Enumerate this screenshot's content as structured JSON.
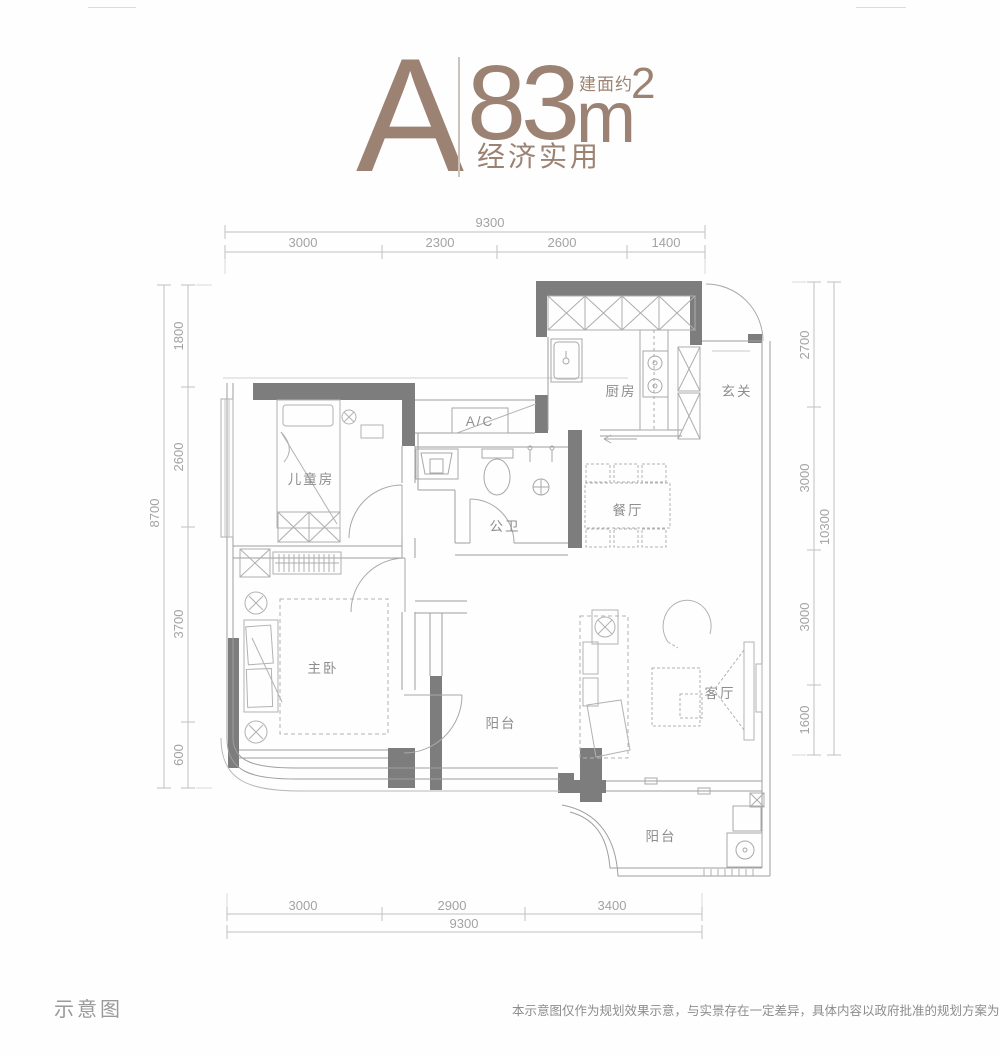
{
  "header": {
    "unit": "A",
    "area_prefix": "建面约",
    "area_value": "83",
    "area_unit": "m",
    "area_exponent": "2",
    "tagline": "经济实用"
  },
  "dimensions": {
    "top": {
      "total": "9300",
      "segments": [
        "3000",
        "2300",
        "2600",
        "1400"
      ]
    },
    "bottom": {
      "total": "9300",
      "segments": [
        "3000",
        "2900",
        "3400"
      ]
    },
    "left": {
      "total": "8700",
      "segments": [
        "1800",
        "2600",
        "3700",
        "600"
      ]
    },
    "right": {
      "total": "10300",
      "segments": [
        "2700",
        "3000",
        "3000",
        "1600"
      ]
    }
  },
  "rooms": {
    "kitchen": "厨房",
    "foyer": "玄关",
    "kids_room": "儿童房",
    "ac_unit": "A/C",
    "bathroom": "公卫",
    "dining": "餐厅",
    "master_bedroom": "主卧",
    "balcony_middle": "阳台",
    "living_room": "客厅",
    "balcony_bottom": "阳台"
  },
  "footer": {
    "caption": "示意图",
    "disclaimer": "本示意图仅作为规划效果示意，与实景存在一定差异，具体内容以政府批准的规划方案为准。"
  },
  "colors": {
    "accent": "#9c8273",
    "wall_fill": "#7d7d7d",
    "dimension_line": "#bfbfbf"
  }
}
